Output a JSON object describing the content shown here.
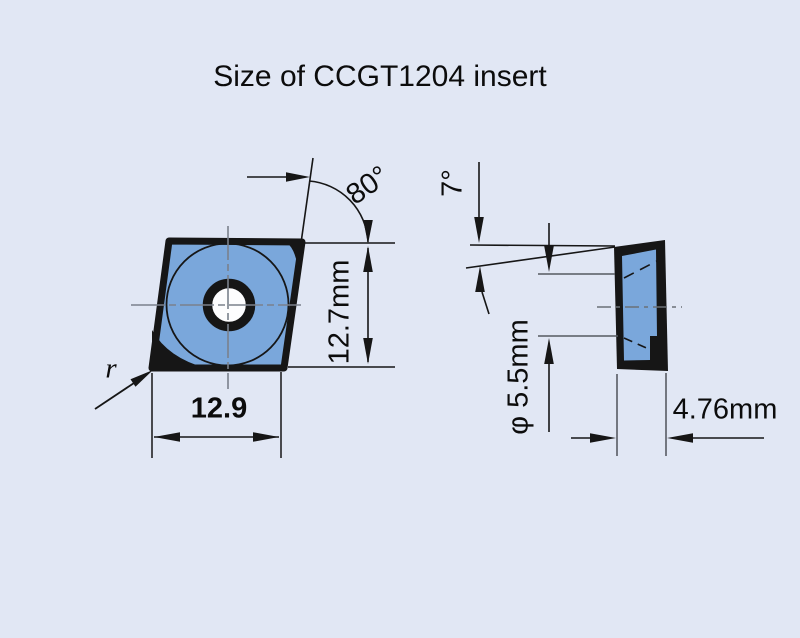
{
  "title": "Size of CCGT1204 insert",
  "front_view": {
    "corner_angle": "80°",
    "height": "12.7mm",
    "width": "12.9",
    "corner_radius": "r"
  },
  "side_view": {
    "relief_angle": "7°",
    "hole_diameter": "φ 5.5mm",
    "thickness": "4.76mm"
  },
  "colors": {
    "background": "#e1e7f4",
    "insert_fill": "#7aa7db",
    "outline": "#161616",
    "centerline": "#7b818c"
  }
}
